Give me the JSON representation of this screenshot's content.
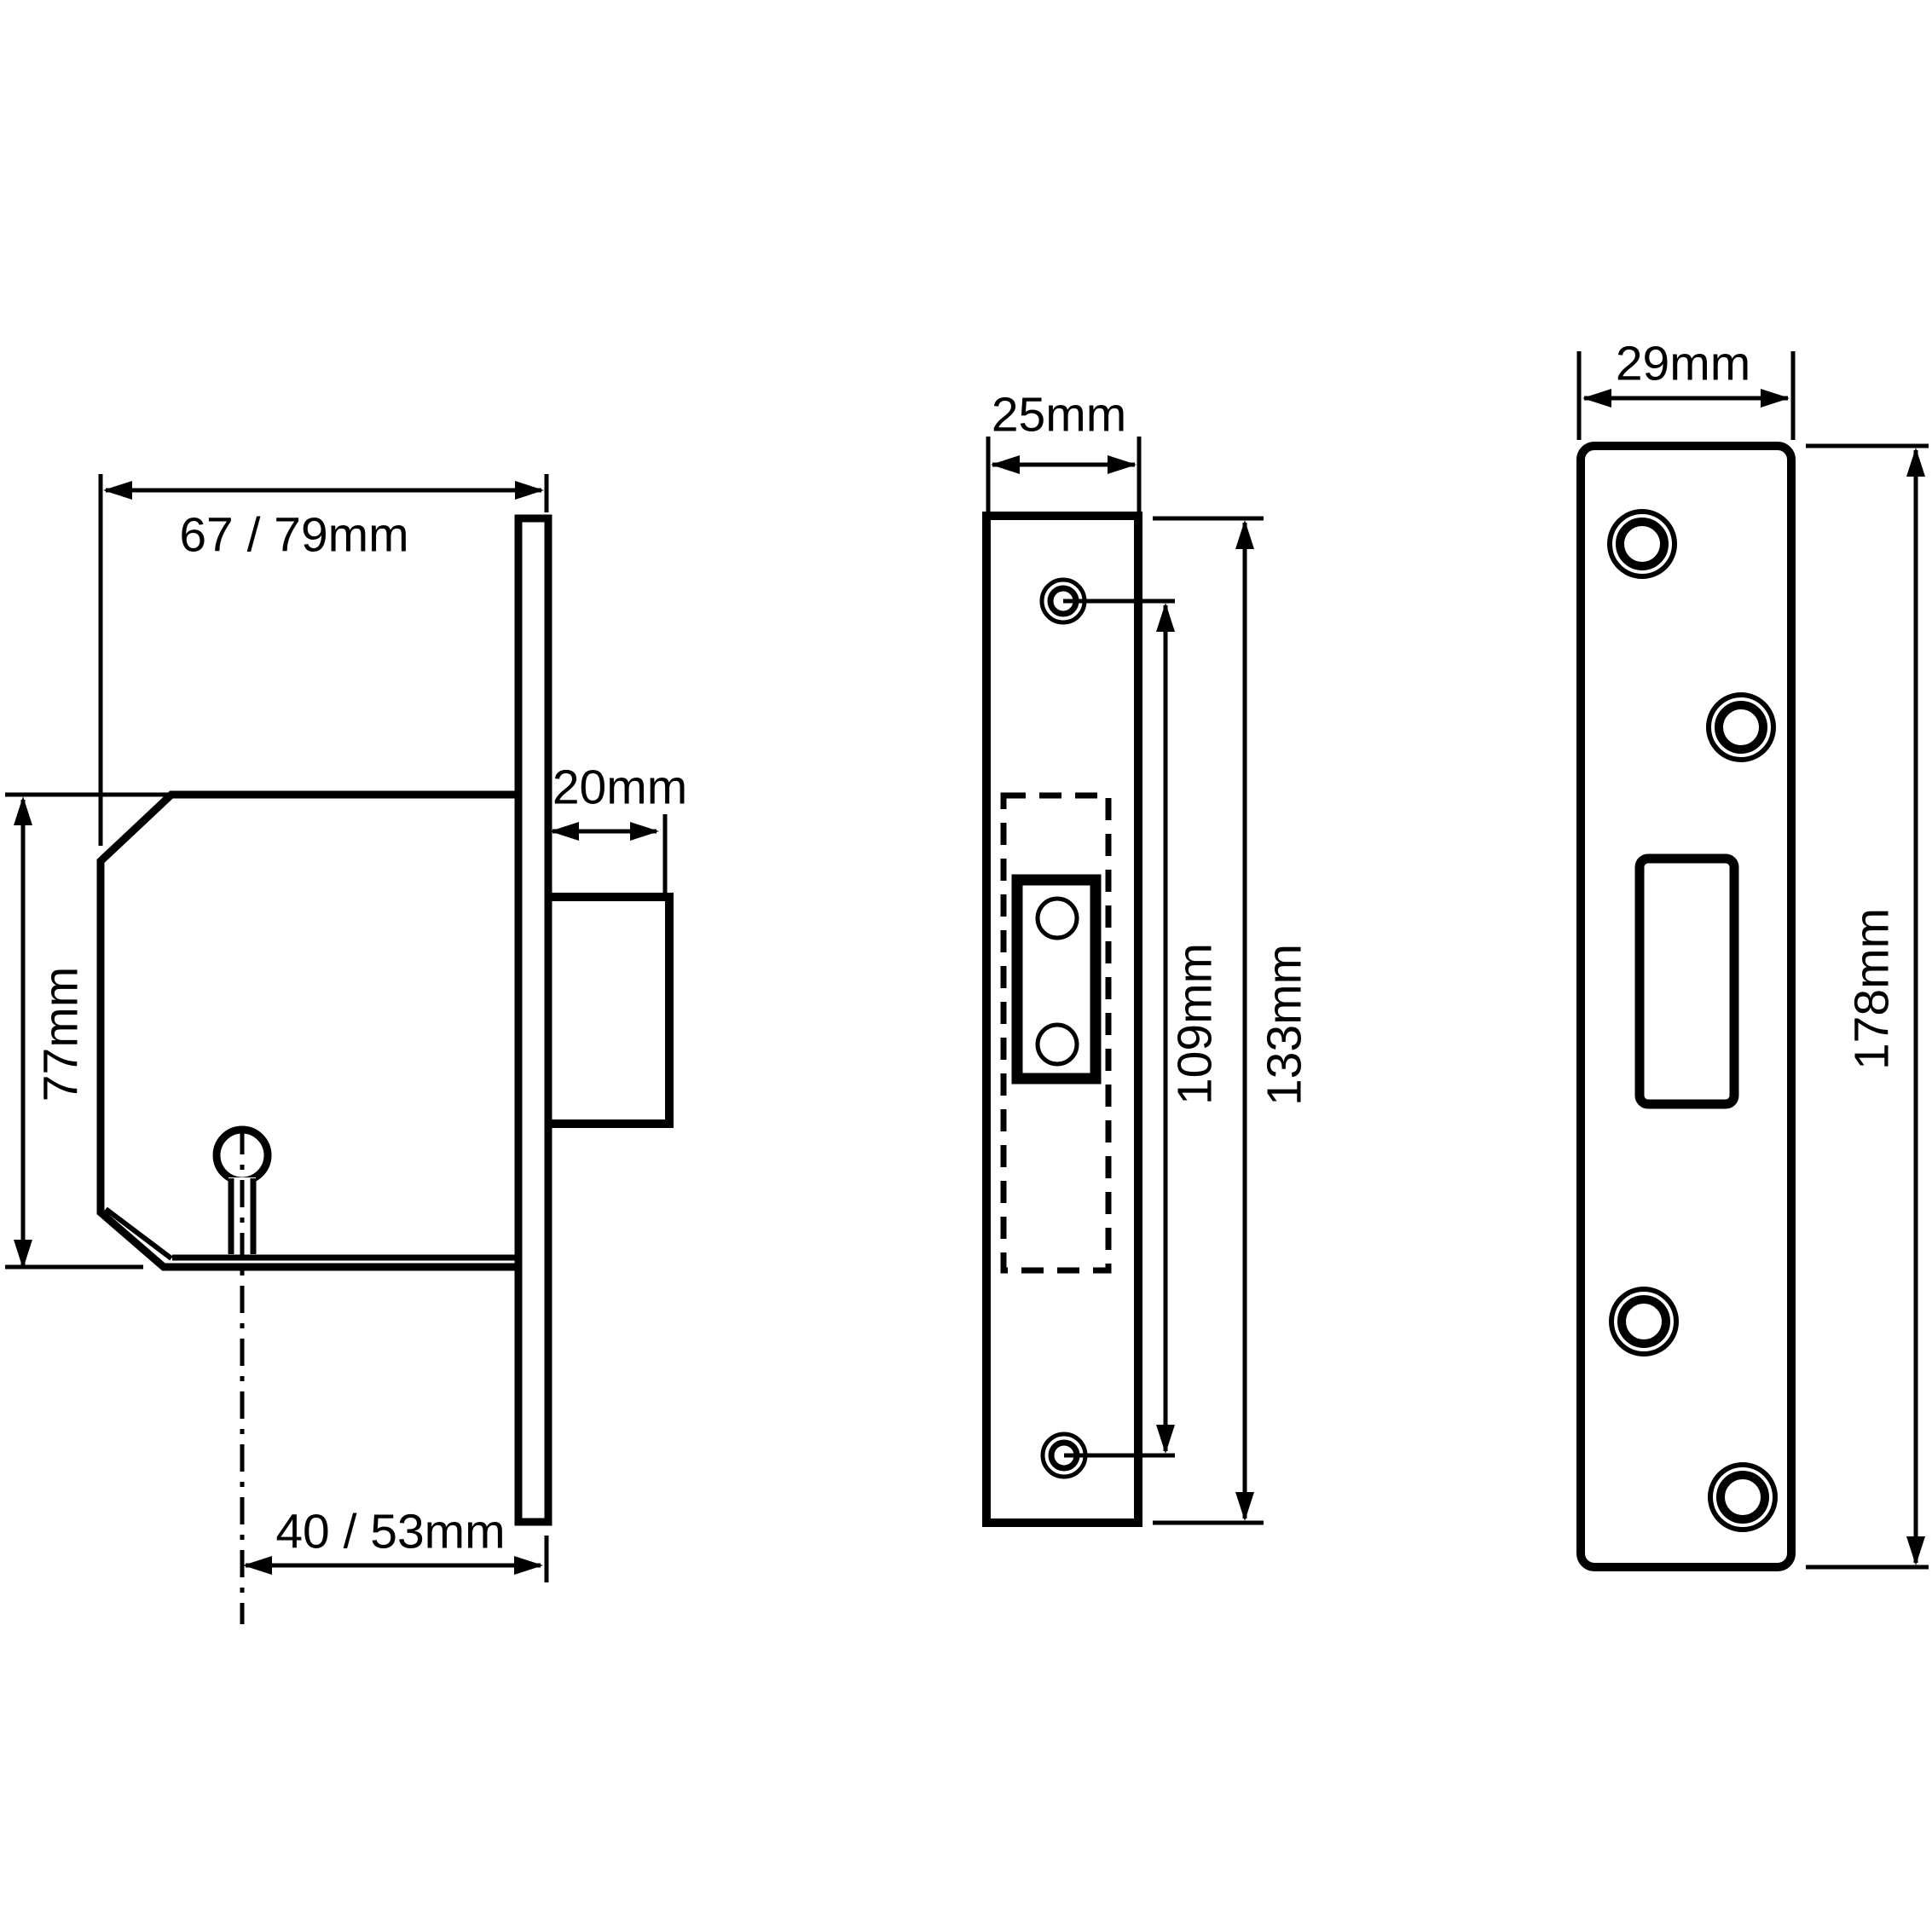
{
  "drawing": {
    "type": "technical-dimension-drawing",
    "subject": "mortice deadlock - lock case, faceplate and strike plate",
    "ink_color": "#000000",
    "background_color": "#ffffff",
    "views": {
      "side": {
        "name": "lock case side view",
        "dimensions": {
          "case_width": "67 / 79mm",
          "case_height": "77mm",
          "bolt_throw": "20mm",
          "backset": "40 / 53mm"
        }
      },
      "front": {
        "name": "faceplate front view",
        "dimensions": {
          "faceplate_width": "25mm",
          "screw_centres": "109mm",
          "faceplate_height": "133mm"
        }
      },
      "strike": {
        "name": "strike plate view",
        "dimensions": {
          "plate_width": "29mm",
          "plate_height": "178mm"
        }
      }
    }
  }
}
